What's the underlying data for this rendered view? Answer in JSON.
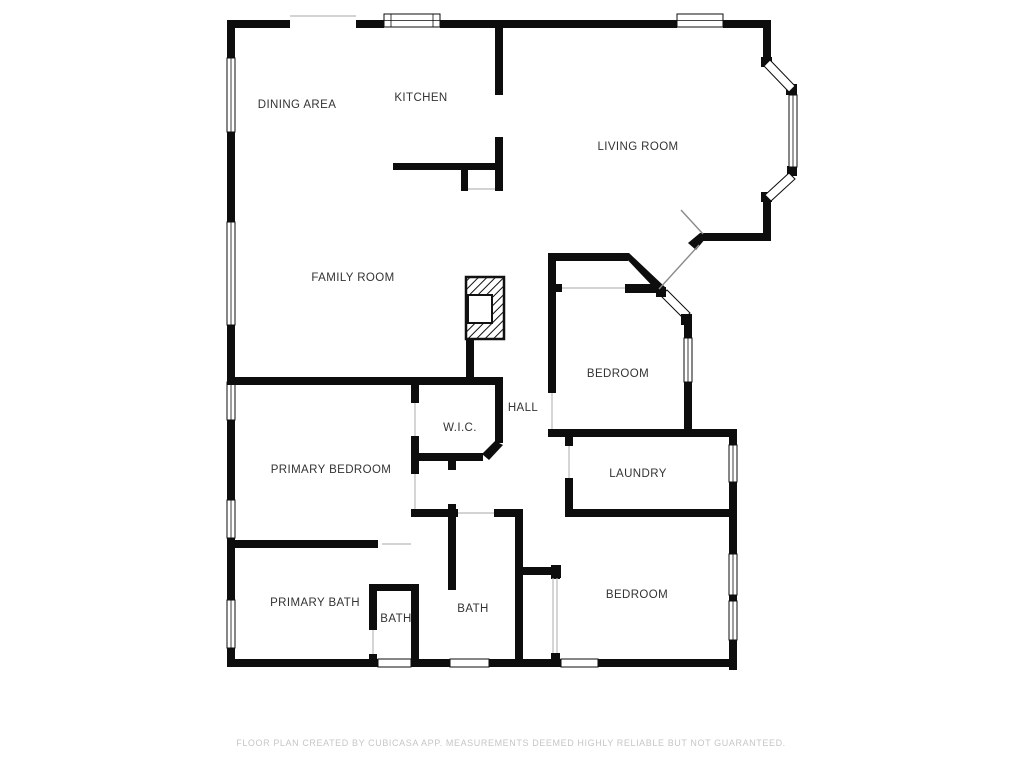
{
  "plan": {
    "title": "floor-plan",
    "footer": "FLOOR PLAN CREATED BY CUBICASA APP. MEASUREMENTS DEEMED HIGHLY RELIABLE BUT NOT GUARANTEED.",
    "colors": {
      "background": "#ffffff",
      "wall": "#0d0d0d",
      "label": "#333333",
      "footer": "#c6c6c6"
    }
  },
  "rooms": [
    {
      "id": "dining-area",
      "label": "DINING AREA"
    },
    {
      "id": "kitchen",
      "label": "KITCHEN"
    },
    {
      "id": "living-room",
      "label": "LIVING ROOM"
    },
    {
      "id": "family-room",
      "label": "FAMILY ROOM"
    },
    {
      "id": "bedroom-middle",
      "label": "BEDROOM"
    },
    {
      "id": "hall",
      "label": "HALL"
    },
    {
      "id": "wic",
      "label": "W.I.C."
    },
    {
      "id": "primary-bedroom",
      "label": "PRIMARY BEDROOM"
    },
    {
      "id": "laundry",
      "label": "LAUNDRY"
    },
    {
      "id": "primary-bath",
      "label": "PRIMARY BATH"
    },
    {
      "id": "bath-small",
      "label": "BATH"
    },
    {
      "id": "bath-middle",
      "label": "BATH"
    },
    {
      "id": "bedroom-bottom",
      "label": "BEDROOM"
    }
  ]
}
